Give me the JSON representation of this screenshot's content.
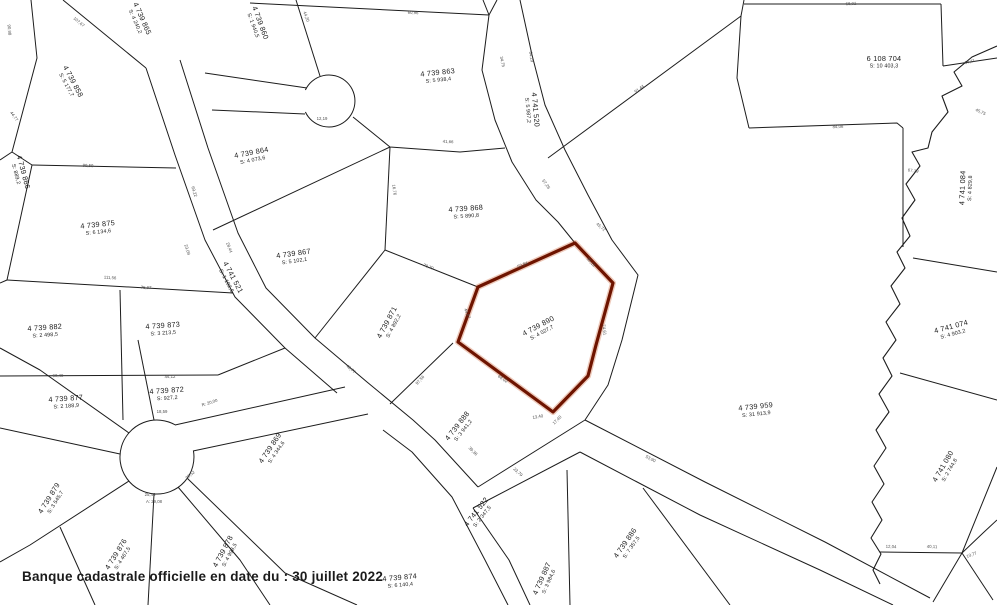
{
  "banner": {
    "text": "Banque cadastrale officielle en date du : 30 juillet 2022"
  },
  "map": {
    "background": "#ffffff",
    "line_color": "#1c1c1c",
    "highlight_color": "#6e1400",
    "highlight_glow": "#c2410c",
    "label_color": "#1a1a1a",
    "dim_color": "#4f4f4f",
    "selected_parcel": {
      "lot": "4 739 890",
      "area": "S: 4 027,7",
      "polygon": [
        [
          575,
          243
        ],
        [
          613,
          283
        ],
        [
          596,
          345
        ],
        [
          588,
          376
        ],
        [
          553,
          412
        ],
        [
          458,
          342
        ],
        [
          478,
          287
        ]
      ]
    },
    "parcels": [
      {
        "lot": "4 739 890",
        "area": "S: 4 027,7",
        "x": 540,
        "y": 329,
        "rot": -28,
        "selected": true
      },
      {
        "lot": "4 739 866",
        "area": "S: 889,2",
        "x": 20,
        "y": 173,
        "rot": 75
      },
      {
        "lot": "4 739 858",
        "area": "S: 5 177,7",
        "x": 70,
        "y": 83,
        "rot": 62
      },
      {
        "lot": "4 739 865",
        "area": "S: 4 240,2",
        "x": 139,
        "y": 20,
        "rot": 66
      },
      {
        "lot": "4 739 860",
        "area": "S: 1 940,5",
        "x": 257,
        "y": 24,
        "rot": 70
      },
      {
        "lot": "4 739 863",
        "area": "S: 5 938,4",
        "x": 438,
        "y": 76,
        "rot": -6
      },
      {
        "lot": "4 741 520",
        "area": "S: 5 987,2",
        "x": 532,
        "y": 110,
        "rot": 85
      },
      {
        "lot": "6 108 704",
        "area": "S: 10 403,3",
        "x": 884,
        "y": 62,
        "rot": 0
      },
      {
        "lot": "4 741 084",
        "area": "S: 4 829,8",
        "x": 966,
        "y": 188,
        "rot": -88
      },
      {
        "lot": "4 741 074",
        "area": "S: 4 903,2",
        "x": 952,
        "y": 330,
        "rot": -15
      },
      {
        "lot": "4 741 080",
        "area": "S: 2 744,8",
        "x": 946,
        "y": 468,
        "rot": -60
      },
      {
        "lot": "4 739 959",
        "area": "S: 31 913,9",
        "x": 756,
        "y": 410,
        "rot": -6
      },
      {
        "lot": "4 739 875",
        "area": "S: 6 134,6",
        "x": 98,
        "y": 228,
        "rot": -6
      },
      {
        "lot": "4 739 882",
        "area": "S: 2 498,5",
        "x": 45,
        "y": 331,
        "rot": -4
      },
      {
        "lot": "4 739 873",
        "area": "S: 3 213,5",
        "x": 163,
        "y": 329,
        "rot": -4
      },
      {
        "lot": "4 741 521",
        "area": "S: 1 102,5",
        "x": 230,
        "y": 279,
        "rot": 62
      },
      {
        "lot": "4 739 877",
        "area": "S: 2 188,9",
        "x": 66,
        "y": 402,
        "rot": -4
      },
      {
        "lot": "4 739 872",
        "area": "S: 927,2",
        "x": 167,
        "y": 394,
        "rot": -4
      },
      {
        "lot": "4 739 879",
        "area": "S: 3 545,7",
        "x": 52,
        "y": 500,
        "rot": -58
      },
      {
        "lot": "4 739 876",
        "area": "S: 4 467,5",
        "x": 119,
        "y": 556,
        "rot": -58
      },
      {
        "lot": "4 739 878",
        "area": "S: 4 998,5",
        "x": 226,
        "y": 553,
        "rot": -62
      },
      {
        "lot": "4 739 864",
        "area": "S: 4 073,6",
        "x": 252,
        "y": 156,
        "rot": -11
      },
      {
        "lot": "4 739 867",
        "area": "S: 5 102,1",
        "x": 294,
        "y": 257,
        "rot": -8
      },
      {
        "lot": "4 739 868",
        "area": "S: 5 890,8",
        "x": 466,
        "y": 212,
        "rot": -4
      },
      {
        "lot": "4 739 871",
        "area": "S: 4 892,2",
        "x": 390,
        "y": 324,
        "rot": -62
      },
      {
        "lot": "4 739 888",
        "area": "S: 3 941,2",
        "x": 460,
        "y": 428,
        "rot": -52
      },
      {
        "lot": "4 741 522",
        "area": "S: 2 347,5",
        "x": 479,
        "y": 514,
        "rot": -52
      },
      {
        "lot": "4 739 869",
        "area": "S: 4 344,6",
        "x": 273,
        "y": 450,
        "rot": -56
      },
      {
        "lot": "4 739 874",
        "area": "S: 6 140,4",
        "x": 400,
        "y": 581,
        "rot": -5
      },
      {
        "lot": "4 739 887",
        "area": "S: 3 984,6",
        "x": 545,
        "y": 580,
        "rot": -66
      },
      {
        "lot": "4 739 886",
        "area": "S: 7 357,5",
        "x": 628,
        "y": 545,
        "rot": -55
      }
    ],
    "lines": [
      [
        [
          31,
          0
        ],
        [
          37,
          58
        ],
        [
          12,
          152
        ],
        [
          0,
          160
        ]
      ],
      [
        [
          12,
          152
        ],
        [
          32,
          165
        ]
      ],
      [
        [
          63,
          0
        ],
        [
          146,
          68
        ]
      ],
      [
        [
          146,
          68
        ],
        [
          175,
          155
        ],
        [
          205,
          240
        ],
        [
          235,
          297
        ],
        [
          285,
          348
        ],
        [
          337,
          393
        ]
      ],
      [
        [
          383,
          430
        ],
        [
          412,
          452
        ],
        [
          452,
          497
        ],
        [
          485,
          560
        ],
        [
          508,
          605
        ]
      ],
      [
        [
          180,
          60
        ],
        [
          208,
          148
        ],
        [
          238,
          233
        ],
        [
          266,
          288
        ],
        [
          315,
          338
        ],
        [
          367,
          382
        ],
        [
          413,
          420
        ],
        [
          435,
          440
        ],
        [
          478,
          487
        ]
      ],
      [
        [
          205,
          73
        ],
        [
          307,
          88
        ]
      ],
      [
        [
          212,
          110
        ],
        [
          305,
          114
        ]
      ],
      [
        [
          296,
          0
        ],
        [
          320,
          76
        ]
      ],
      [
        [
          250,
          3
        ],
        [
          489,
          15
        ]
      ],
      [
        [
          489,
          15
        ],
        [
          483,
          0
        ]
      ],
      [
        [
          497,
          0
        ],
        [
          489,
          15
        ],
        [
          482,
          70
        ],
        [
          495,
          120
        ],
        [
          512,
          162
        ],
        [
          536,
          200
        ],
        [
          558,
          222
        ],
        [
          575,
          243
        ]
      ],
      [
        [
          520,
          0
        ],
        [
          532,
          55
        ],
        [
          545,
          105
        ],
        [
          565,
          150
        ],
        [
          588,
          195
        ],
        [
          612,
          240
        ],
        [
          638,
          275
        ],
        [
          622,
          340
        ],
        [
          608,
          385
        ],
        [
          585,
          420
        ]
      ],
      [
        [
          548,
          158
        ],
        [
          741,
          16
        ]
      ],
      [
        [
          741,
          16
        ],
        [
          744,
          0
        ]
      ],
      [
        [
          741,
          16
        ],
        [
          737,
          78
        ],
        [
          749,
          128
        ]
      ],
      [
        [
          749,
          128
        ],
        [
          897,
          123
        ],
        [
          903,
          128
        ]
      ],
      [
        [
          744,
          4
        ],
        [
          941,
          4
        ]
      ],
      [
        [
          941,
          4
        ],
        [
          943,
          66
        ]
      ],
      [
        [
          943,
          66
        ],
        [
          997,
          58
        ]
      ],
      [
        [
          903,
          128
        ],
        [
          903,
          247
        ]
      ],
      [
        [
          913,
          258
        ],
        [
          997,
          272
        ]
      ],
      [
        [
          900,
          373
        ],
        [
          997,
          400
        ]
      ],
      [
        [
          880,
          552
        ],
        [
          962,
          553
        ]
      ],
      [
        [
          997,
          467
        ],
        [
          962,
          553
        ],
        [
          933,
          602
        ]
      ],
      [
        [
          997,
          520
        ],
        [
          983,
          533
        ],
        [
          962,
          553
        ]
      ],
      [
        [
          962,
          553
        ],
        [
          993,
          600
        ]
      ],
      [
        [
          580,
          452
        ],
        [
          700,
          515
        ],
        [
          820,
          570
        ],
        [
          893,
          605
        ]
      ],
      [
        [
          585,
          420
        ],
        [
          705,
          482
        ],
        [
          825,
          542
        ],
        [
          930,
          598
        ]
      ],
      [
        [
          478,
          487
        ],
        [
          585,
          420
        ]
      ],
      [
        [
          473,
          508
        ],
        [
          580,
          452
        ]
      ],
      [
        [
          473,
          508
        ],
        [
          509,
          560
        ],
        [
          530,
          605
        ]
      ],
      [
        [
          567,
          470
        ],
        [
          570,
          605
        ]
      ],
      [
        [
          643,
          488
        ],
        [
          730,
          605
        ]
      ],
      [
        [
          453,
          343
        ],
        [
          390,
          404
        ]
      ],
      [
        [
          385,
          250
        ],
        [
          478,
          287
        ]
      ],
      [
        [
          385,
          250
        ],
        [
          315,
          338
        ]
      ],
      [
        [
          390,
          147
        ],
        [
          385,
          250
        ]
      ],
      [
        [
          213,
          230
        ],
        [
          390,
          147
        ]
      ],
      [
        [
          353,
          117
        ],
        [
          390,
          147
        ],
        [
          460,
          152
        ],
        [
          505,
          148
        ]
      ],
      [
        [
          32,
          165
        ],
        [
          176,
          168
        ]
      ],
      [
        [
          32,
          165
        ],
        [
          7,
          280
        ],
        [
          0,
          283
        ]
      ],
      [
        [
          7,
          280
        ],
        [
          233,
          293
        ]
      ],
      [
        [
          120,
          290
        ],
        [
          123,
          420
        ]
      ],
      [
        [
          0,
          376
        ],
        [
          218,
          375
        ]
      ],
      [
        [
          218,
          375
        ],
        [
          285,
          348
        ]
      ],
      [
        [
          120,
          454
        ],
        [
          0,
          428
        ]
      ],
      [
        [
          129,
          433
        ],
        [
          40,
          370
        ],
        [
          0,
          348
        ]
      ],
      [
        [
          154,
          420
        ],
        [
          138,
          340
        ]
      ],
      [
        [
          129,
          481
        ],
        [
          30,
          545
        ],
        [
          0,
          562
        ]
      ],
      [
        [
          154,
          494
        ],
        [
          148,
          605
        ]
      ],
      [
        [
          178,
          487
        ],
        [
          240,
          560
        ],
        [
          270,
          605
        ]
      ],
      [
        [
          187,
          478
        ],
        [
          285,
          573
        ],
        [
          357,
          605
        ]
      ],
      [
        [
          60,
          527
        ],
        [
          95,
          605
        ]
      ],
      [
        [
          175,
          425
        ],
        [
          345,
          387
        ]
      ],
      [
        [
          193,
          451
        ],
        [
          368,
          414
        ]
      ]
    ],
    "arcs": [
      "M193.4 450.6 A37 37 0 1 1 175.5 425",
      "M305.4 90 A26 26 0 1 1 305.4 112"
    ],
    "stream": [
      [
        997,
        46
      ],
      [
        972,
        57
      ],
      [
        954,
        72
      ],
      [
        962,
        86
      ],
      [
        942,
        96
      ],
      [
        948,
        112
      ],
      [
        932,
        132
      ],
      [
        928,
        148
      ],
      [
        912,
        152
      ],
      [
        920,
        166
      ],
      [
        906,
        184
      ],
      [
        915,
        200
      ],
      [
        902,
        218
      ],
      [
        910,
        236
      ],
      [
        897,
        252
      ],
      [
        905,
        268
      ],
      [
        891,
        286
      ],
      [
        900,
        304
      ],
      [
        886,
        322
      ],
      [
        896,
        340
      ],
      [
        883,
        358
      ],
      [
        892,
        376
      ],
      [
        879,
        394
      ],
      [
        889,
        412
      ],
      [
        876,
        430
      ],
      [
        886,
        448
      ],
      [
        874,
        466
      ],
      [
        884,
        484
      ],
      [
        872,
        502
      ],
      [
        882,
        520
      ],
      [
        871,
        538
      ],
      [
        881,
        554
      ],
      [
        873,
        570
      ],
      [
        880,
        584
      ]
    ],
    "dimensions": [
      {
        "t": "90,98",
        "x": 8,
        "y": 30,
        "r": 85
      },
      {
        "t": "107,67",
        "x": 78,
        "y": 23,
        "r": 40
      },
      {
        "t": "44,77",
        "x": 13,
        "y": 117,
        "r": 55
      },
      {
        "t": "44,20",
        "x": 305,
        "y": 17,
        "r": 70
      },
      {
        "t": "60,96",
        "x": 413,
        "y": 14,
        "r": 3
      },
      {
        "t": "34,75",
        "x": 501,
        "y": 62,
        "r": 78
      },
      {
        "t": "64,29",
        "x": 530,
        "y": 57,
        "r": 80
      },
      {
        "t": "12,19",
        "x": 322,
        "y": 120,
        "r": 0
      },
      {
        "t": "41,66",
        "x": 448,
        "y": 143,
        "r": 3
      },
      {
        "t": "91,44",
        "x": 640,
        "y": 90,
        "r": -36
      },
      {
        "t": "68,01",
        "x": 851,
        "y": 5,
        "r": -2
      },
      {
        "t": "64,11",
        "x": 970,
        "y": 63,
        "r": -15
      },
      {
        "t": "45,75",
        "x": 980,
        "y": 113,
        "r": 25
      },
      {
        "t": "84,08",
        "x": 838,
        "y": 128,
        "r": -2
      },
      {
        "t": "67,19",
        "x": 913,
        "y": 172,
        "r": 8
      },
      {
        "t": "99,59",
        "x": 88,
        "y": 167,
        "r": 2
      },
      {
        "t": "111,56",
        "x": 110,
        "y": 279,
        "r": 3
      },
      {
        "t": "75,87",
        "x": 146,
        "y": 289,
        "r": 3
      },
      {
        "t": "69,22",
        "x": 193,
        "y": 192,
        "r": 72
      },
      {
        "t": "23,09",
        "x": 186,
        "y": 250,
        "r": 72
      },
      {
        "t": "28,44",
        "x": 228,
        "y": 248,
        "r": 70
      },
      {
        "t": "57,26",
        "x": 545,
        "y": 185,
        "r": 55
      },
      {
        "t": "45,72",
        "x": 600,
        "y": 228,
        "r": 40
      },
      {
        "t": "98,40",
        "x": 58,
        "y": 377,
        "r": -1
      },
      {
        "t": "44,12",
        "x": 170,
        "y": 378,
        "r": -1
      },
      {
        "t": "36,52",
        "x": 191,
        "y": 476,
        "r": -40
      },
      {
        "t": "25,46",
        "x": 150,
        "y": 496,
        "r": 0
      },
      {
        "t": "A: 29,08",
        "x": 154,
        "y": 503,
        "r": 0
      },
      {
        "t": "R: 20,00",
        "x": 210,
        "y": 404,
        "r": -18
      },
      {
        "t": "18,59",
        "x": 162,
        "y": 413,
        "r": 0
      },
      {
        "t": "52,84",
        "x": 523,
        "y": 266,
        "r": -22
      },
      {
        "t": "30,19",
        "x": 590,
        "y": 263,
        "r": 48
      },
      {
        "t": "74,61",
        "x": 603,
        "y": 330,
        "r": 82
      },
      {
        "t": "68,02",
        "x": 502,
        "y": 380,
        "r": 34
      },
      {
        "t": "49,07",
        "x": 466,
        "y": 314,
        "r": 68
      },
      {
        "t": "97,56",
        "x": 421,
        "y": 381,
        "r": -48
      },
      {
        "t": "16,76",
        "x": 393,
        "y": 190,
        "r": 82
      },
      {
        "t": "70,79",
        "x": 428,
        "y": 268,
        "r": 20
      },
      {
        "t": "39,36",
        "x": 472,
        "y": 452,
        "r": 45
      },
      {
        "t": "23,79",
        "x": 517,
        "y": 473,
        "r": 42
      },
      {
        "t": "13,40",
        "x": 538,
        "y": 418,
        "r": -10
      },
      {
        "t": "17,40",
        "x": 558,
        "y": 421,
        "r": -45
      },
      {
        "t": "53,90",
        "x": 650,
        "y": 460,
        "r": 27
      },
      {
        "t": "48,77",
        "x": 350,
        "y": 370,
        "r": 42
      },
      {
        "t": "40,11",
        "x": 932,
        "y": 548,
        "r": 2
      },
      {
        "t": "10,77",
        "x": 972,
        "y": 556,
        "r": -20
      },
      {
        "t": "12,04",
        "x": 891,
        "y": 548,
        "r": 2
      }
    ]
  }
}
